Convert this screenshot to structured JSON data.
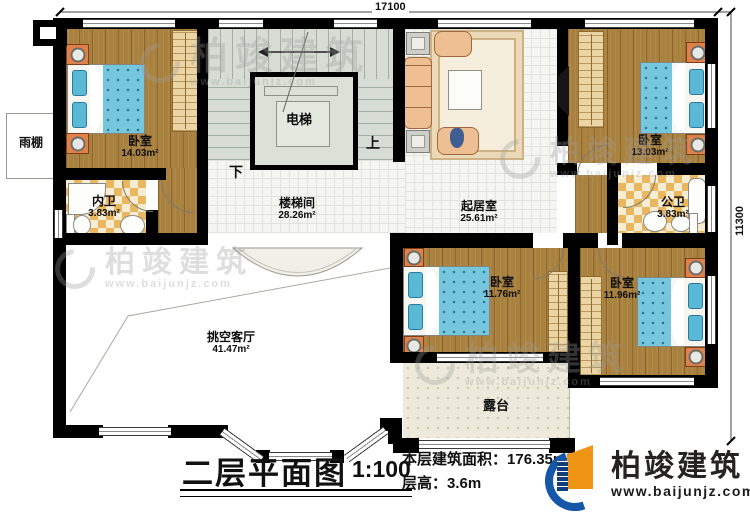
{
  "dims": {
    "width": "17100",
    "height": "11300"
  },
  "rooms": {
    "bedroom_tl": {
      "name": "卧室",
      "area": "14.03m²"
    },
    "inner_bath": {
      "name": "内卫",
      "area": "3.83m²"
    },
    "stairwell": {
      "name": "楼梯间",
      "area": "28.26m²"
    },
    "elevator": {
      "name": "电梯"
    },
    "living": {
      "name": "起居室",
      "area": "25.61m²"
    },
    "bedroom_tr": {
      "name": "卧室",
      "area": "13.03m²"
    },
    "public_bath": {
      "name": "公卫",
      "area": "3.83m²"
    },
    "bedroom_bm": {
      "name": "卧室",
      "area": "11.76m²"
    },
    "bedroom_br": {
      "name": "卧室",
      "area": "11.96m²"
    },
    "void_living": {
      "name": "挑空客厅",
      "area": "41.47m²"
    },
    "terrace": {
      "name": "露台"
    },
    "canopy": {
      "name": "雨棚"
    }
  },
  "stairs": {
    "up": "上",
    "down": "下"
  },
  "titleblock": {
    "title": "二层平面图",
    "scale": "1:100",
    "area_label": "本层建筑面积：",
    "area_value": "176.35m²",
    "height_label": "层高：",
    "height_value": "3.6m"
  },
  "brand": {
    "name": "柏竣建筑",
    "url": "www.baijunjz.com"
  },
  "watermark": {
    "name": "柏竣建筑",
    "url": "www.baijunjz.com"
  }
}
